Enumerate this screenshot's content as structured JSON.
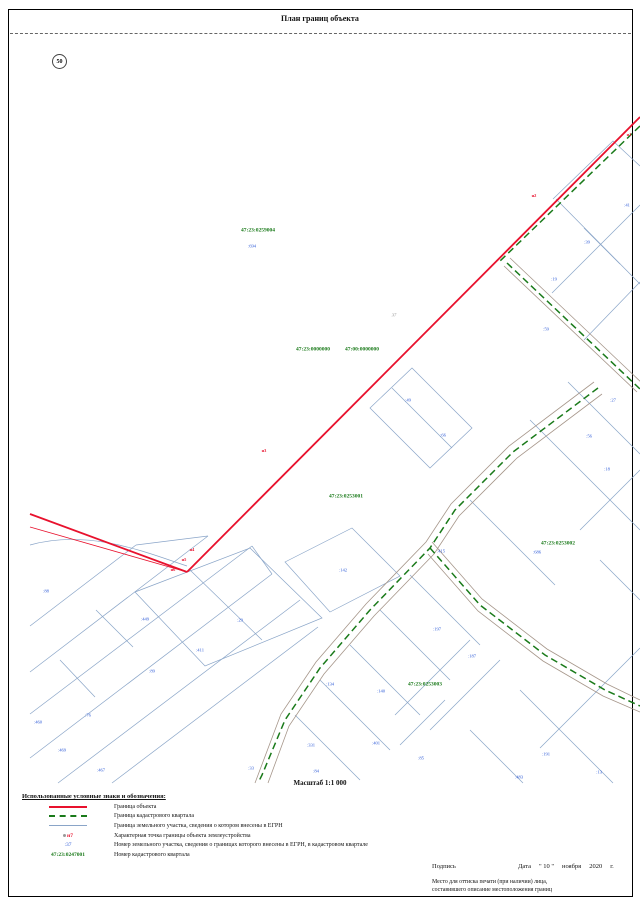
{
  "header": {
    "title": "План границ объекта",
    "page_number": "50"
  },
  "map": {
    "scale_label": "Масштаб 1:1 000",
    "colors": {
      "object_boundary": "#e8112d",
      "quarter_boundary": "#1a7a1a",
      "parcel_line": "#8aa5c8",
      "parcel_number": "#2e5bd7",
      "road": "#a6968a"
    },
    "labels": [
      {
        "text": "47:23:0259004",
        "x": 258,
        "y": 231,
        "type": "quarter"
      },
      {
        "text": "47:23:0000000",
        "x": 313,
        "y": 350,
        "type": "quarter"
      },
      {
        "text": "47:00:0000000",
        "x": 362,
        "y": 350,
        "type": "quarter"
      },
      {
        "text": "47:23:0253001",
        "x": 346,
        "y": 497,
        "type": "quarter"
      },
      {
        "text": "47:23:0253002",
        "x": 558,
        "y": 544,
        "type": "quarter"
      },
      {
        "text": "47:23:0253003",
        "x": 425,
        "y": 685,
        "type": "quarter"
      },
      {
        "text": ":694",
        "x": 252,
        "y": 247,
        "type": "parcel"
      },
      {
        "text": ":41",
        "x": 627,
        "y": 206,
        "type": "parcel"
      },
      {
        "text": ":39",
        "x": 587,
        "y": 243,
        "type": "parcel"
      },
      {
        "text": ":19",
        "x": 554,
        "y": 280,
        "type": "parcel"
      },
      {
        "text": ":59",
        "x": 546,
        "y": 330,
        "type": "parcel"
      },
      {
        "text": ":49",
        "x": 408,
        "y": 401,
        "type": "parcel"
      },
      {
        "text": ":66",
        "x": 443,
        "y": 436,
        "type": "parcel"
      },
      {
        "text": ":27",
        "x": 613,
        "y": 401,
        "type": "parcel"
      },
      {
        "text": ":56",
        "x": 589,
        "y": 437,
        "type": "parcel"
      },
      {
        "text": ":18",
        "x": 607,
        "y": 470,
        "type": "parcel"
      },
      {
        "text": ":686",
        "x": 537,
        "y": 553,
        "type": "parcel"
      },
      {
        "text": ":415",
        "x": 441,
        "y": 552,
        "type": "parcel"
      },
      {
        "text": ":142",
        "x": 343,
        "y": 571,
        "type": "parcel"
      },
      {
        "text": ":29",
        "x": 240,
        "y": 621,
        "type": "parcel"
      },
      {
        "text": ":449",
        "x": 145,
        "y": 620,
        "type": "parcel"
      },
      {
        "text": ":88",
        "x": 46,
        "y": 592,
        "type": "parcel"
      },
      {
        "text": ":411",
        "x": 200,
        "y": 651,
        "type": "parcel"
      },
      {
        "text": ":89",
        "x": 152,
        "y": 672,
        "type": "parcel"
      },
      {
        "text": ":76",
        "x": 88,
        "y": 716,
        "type": "parcel"
      },
      {
        "text": ":460",
        "x": 38,
        "y": 723,
        "type": "parcel"
      },
      {
        "text": ":469",
        "x": 62,
        "y": 751,
        "type": "parcel"
      },
      {
        "text": ":467",
        "x": 101,
        "y": 771,
        "type": "parcel"
      },
      {
        "text": ":33",
        "x": 251,
        "y": 769,
        "type": "parcel"
      },
      {
        "text": ":134",
        "x": 330,
        "y": 685,
        "type": "parcel"
      },
      {
        "text": ":140",
        "x": 381,
        "y": 692,
        "type": "parcel"
      },
      {
        "text": ":401",
        "x": 376,
        "y": 744,
        "type": "parcel"
      },
      {
        "text": ":331",
        "x": 311,
        "y": 746,
        "type": "parcel"
      },
      {
        "text": ":84",
        "x": 316,
        "y": 772,
        "type": "parcel"
      },
      {
        "text": ":85",
        "x": 421,
        "y": 759,
        "type": "parcel"
      },
      {
        "text": ":197",
        "x": 437,
        "y": 630,
        "type": "parcel"
      },
      {
        "text": ":187",
        "x": 472,
        "y": 657,
        "type": "parcel"
      },
      {
        "text": ":191",
        "x": 546,
        "y": 755,
        "type": "parcel"
      },
      {
        "text": ":13",
        "x": 599,
        "y": 773,
        "type": "parcel"
      },
      {
        "text": ":483",
        "x": 519,
        "y": 778,
        "type": "parcel"
      },
      {
        "text": "н1",
        "x": 629,
        "y": 135,
        "type": "point"
      },
      {
        "text": "н2",
        "x": 534,
        "y": 196,
        "type": "point"
      },
      {
        "text": "н3",
        "x": 264,
        "y": 451,
        "type": "point"
      },
      {
        "text": "н4",
        "x": 192,
        "y": 550,
        "type": "point"
      },
      {
        "text": "н5",
        "x": 184,
        "y": 560,
        "type": "point"
      },
      {
        "text": "н6",
        "x": 173,
        "y": 570,
        "type": "point"
      },
      {
        "text": "37",
        "x": 394,
        "y": 316,
        "type": "note"
      }
    ]
  },
  "legend": {
    "heading": "Использованные условные знаки и обозначения:",
    "items": [
      {
        "symbol": "object-boundary-line",
        "text": "Граница объекта"
      },
      {
        "symbol": "quarter-boundary-line",
        "text": "Граница кадастрового квартала"
      },
      {
        "symbol": "parcel-boundary-line",
        "text": "Граница земельного участка, сведения о котором внесены в ЕГРН"
      },
      {
        "symbol": "boundary-point",
        "sample": "н7",
        "text": "Характерная точка границы объекта землеустройства"
      },
      {
        "symbol": "parcel-number",
        "sample": ":37",
        "text": "Номер земельного участка, сведения о границах которого внесены в ЕГРН, в кадастровом квартале"
      },
      {
        "symbol": "quarter-number",
        "sample": "47:23:0247001",
        "text": "Номер кадастрового квартала"
      }
    ]
  },
  "footer": {
    "signature_label": "Подпись",
    "date_label": "Дата",
    "date_day": "\" 10 \"",
    "date_month": "ноября",
    "date_year": "2020",
    "date_era": "г.",
    "seal_note_line1": "Место для оттиска печати (при наличии) лица,",
    "seal_note_line2": "составившего описание местоположения границ"
  }
}
